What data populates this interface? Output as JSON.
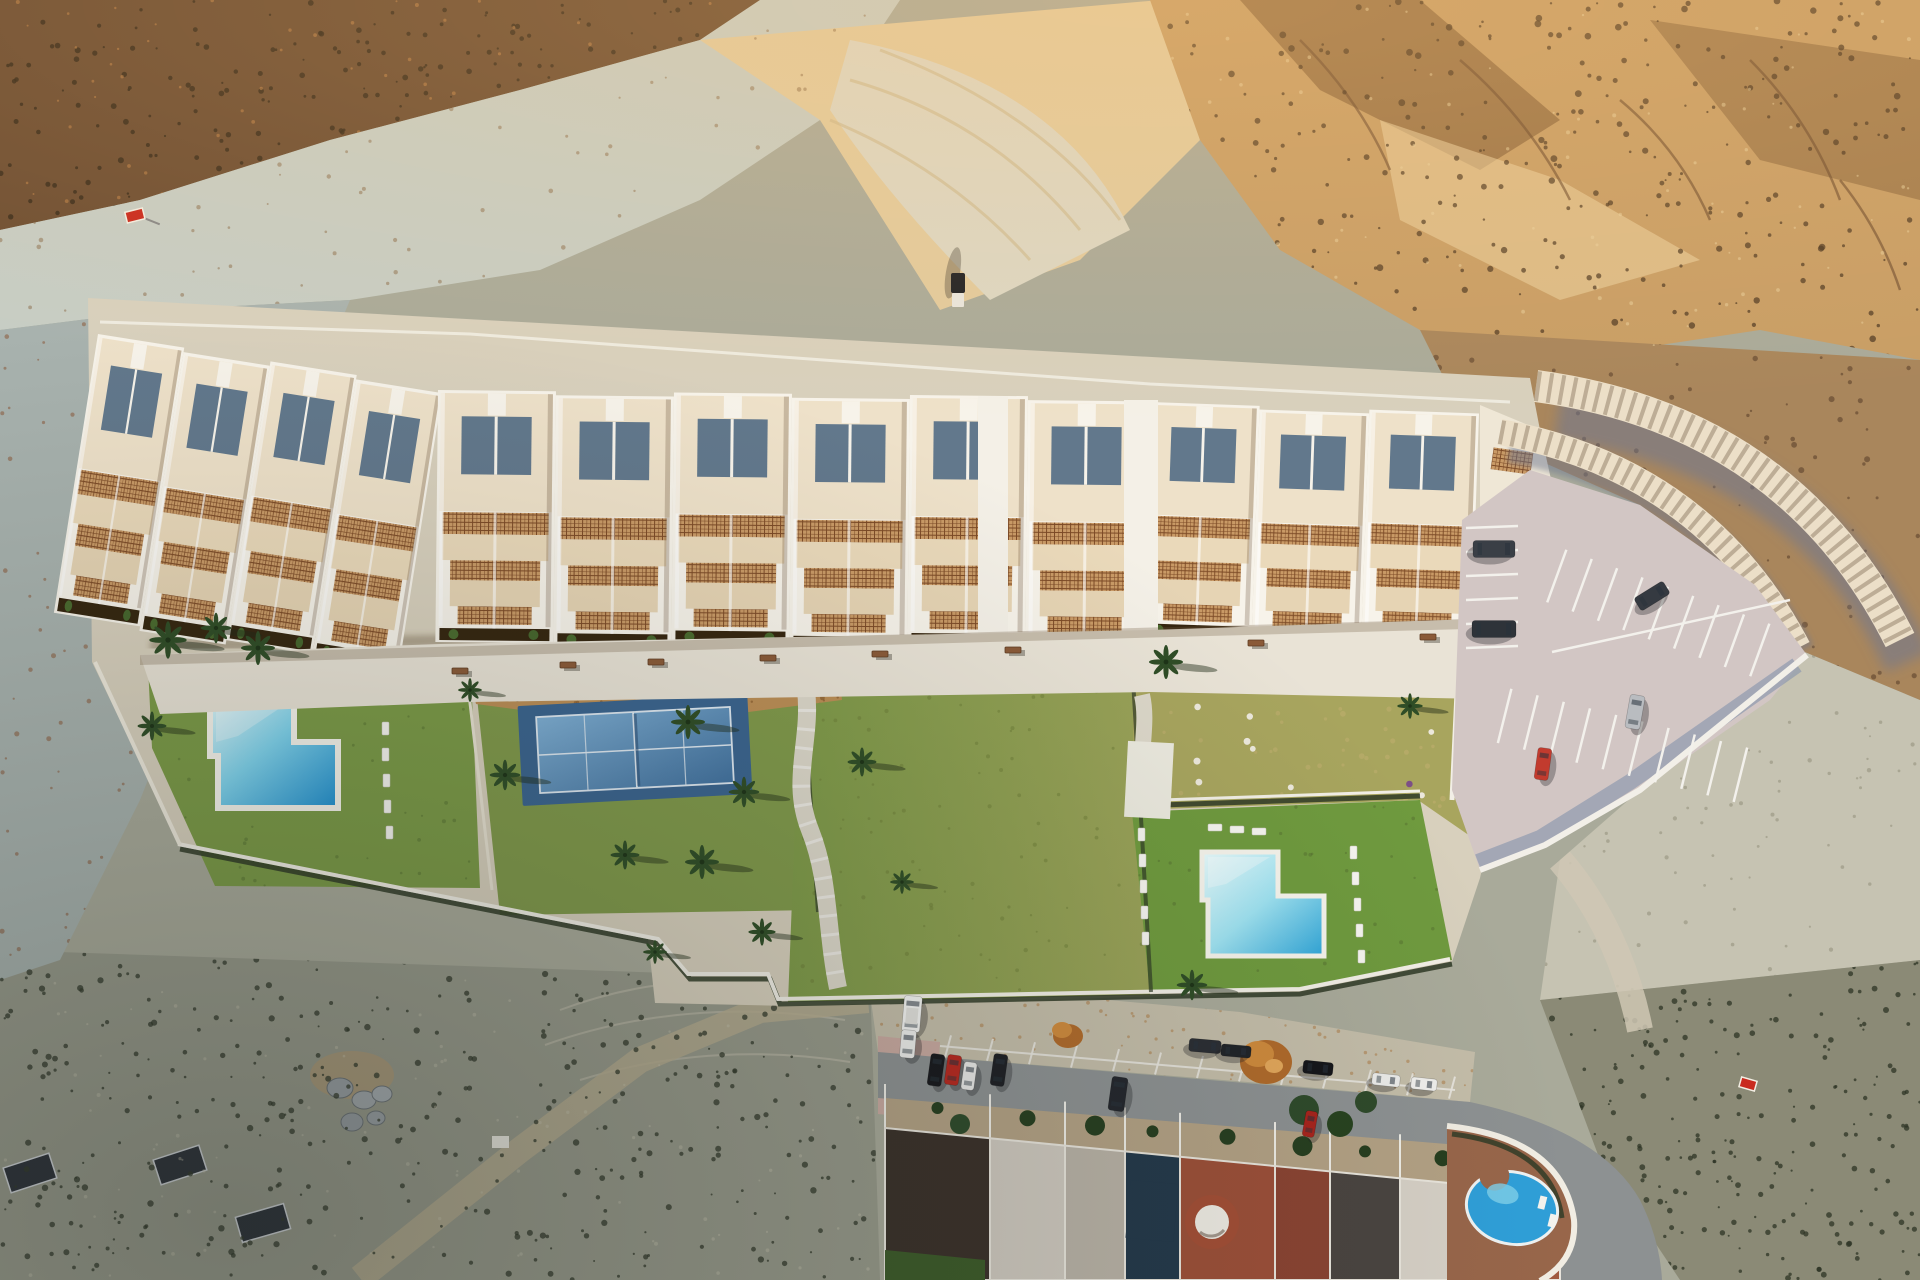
{
  "scene": {
    "type": "aerial-drone-render",
    "description": "Top-down aerial render of a new residential complex on a desert hillside with landscaped gardens, two pools, a padel court and parking, above an existing street of row houses",
    "development": {
      "building_blocks": [
        {
          "name": "west-wing",
          "units": 4
        },
        {
          "name": "central-block",
          "units": 6
        },
        {
          "name": "east-wing",
          "units": 3
        }
      ],
      "amenities": [
        "promenade",
        "swimming-pool-west",
        "padel-court",
        "central-garden",
        "dry-garden",
        "swimming-pool-east",
        "parking-lot"
      ],
      "benches": 8,
      "palm_trees": 17,
      "pool_loungers": 18,
      "parking_cars": [
        {
          "name": "car",
          "color": "#3a3f46"
        },
        {
          "name": "car",
          "color": "#2e3339"
        },
        {
          "name": "car",
          "color": "#353a41"
        },
        {
          "name": "car",
          "color": "#b9bcc0"
        },
        {
          "name": "car",
          "color": "#c23b2e"
        }
      ]
    },
    "street": {
      "house_roofs": [
        {
          "color": "#3a3029"
        },
        {
          "color": "#cfc9bf"
        },
        {
          "color": "#b9b2a6"
        },
        {
          "color": "#23384a"
        },
        {
          "color": "#9c4f38"
        },
        {
          "color": "#8a4332"
        },
        {
          "color": "#4a4440"
        },
        {
          "color": "#d6d0c6"
        },
        {
          "color": "#a05a40"
        }
      ],
      "cars": [
        {
          "name": "van",
          "color": "#f4f4f2"
        },
        {
          "name": "car",
          "color": "#eeeeec"
        },
        {
          "name": "car",
          "color": "#17181c"
        },
        {
          "name": "car",
          "color": "#b7281f"
        },
        {
          "name": "car",
          "color": "#e9e9e7"
        },
        {
          "name": "car",
          "color": "#1d1f24"
        },
        {
          "name": "suv",
          "color": "#23262c"
        },
        {
          "name": "car",
          "color": "#2a2d33"
        },
        {
          "name": "car",
          "color": "#202328"
        },
        {
          "name": "car",
          "color": "#141519"
        },
        {
          "name": "car",
          "color": "#ececea"
        },
        {
          "name": "car",
          "color": "#a8231c"
        },
        {
          "name": "car",
          "color": "#f0efec"
        }
      ],
      "features": [
        "parking-bays",
        "autumn-trees",
        "front-yards",
        "white-dome-roof",
        "villa-round-pool"
      ]
    },
    "signs": [
      {
        "name": "for-sale-sign-west",
        "color": "#c92a1e"
      },
      {
        "name": "for-sale-sign-east",
        "color": "#c92a1e"
      }
    ],
    "offroad_vehicle": {
      "name": "pickup-truck",
      "color": "#1d1f24"
    }
  },
  "colors": {
    "terrain_base": "#a9aa9a",
    "scrub_dark_tl": "#6f4f33",
    "pale_rock": "#c7cdc4",
    "canyon_sand": "#e2cb9e",
    "canyon_floor": "#dcd7c4",
    "ridge_tan": "#c89e66",
    "ridge_shadow": "#7a5632",
    "ridge_highlight": "#ecd3a2",
    "cliff_slope": "#a9865c",
    "left_band": "#a8b2ae",
    "bl_scrub": "#97998a",
    "br_scrub": "#8b8a76",
    "right_slope": "#c6c3b2",
    "dirt_north": "#c4bda9",
    "parcel": "#d8d0bd",
    "promenade": "#e9e3d6",
    "roof_cream": "#eee1c9",
    "wall_white": "#f7f3ea",
    "terrace_slate": "#62788c",
    "planter": "#35250f",
    "lawn_west": "#7b9a46",
    "lawn_tennis": "#80994a",
    "lawn_center": "#7e9a48",
    "lawn_center_dry": "#9aa258",
    "lawn_east": "#6f9a3e",
    "dry_garden": "#a8a55e",
    "mulch": "#bc8e55",
    "court_outer": "#3a648f",
    "pool_light": "#e0f8fb",
    "pool_deep": "#1f8fd0",
    "pool2_light": "#eafcfd",
    "pool2_deep": "#2fa5d8",
    "path_white": "#e3ded0",
    "parking_asphalt": "#d2c6c4",
    "wall_shadow": "#8b97ad",
    "retain_cream": "#ecdfc8",
    "road_asphalt": "#8d9192",
    "sidewalk_pink": "#c9a9a0",
    "yard_tan": "#b3a184",
    "dome_white": "#efece4",
    "dome_base": "#a34e35",
    "villa_deck": "#98664a",
    "villa_pool": "#2f9fd8",
    "hedge": "#2f3a26",
    "palm_green": "#2f4d26",
    "bench_brown": "#8a5a38",
    "orange_tree": "#c77f35"
  }
}
